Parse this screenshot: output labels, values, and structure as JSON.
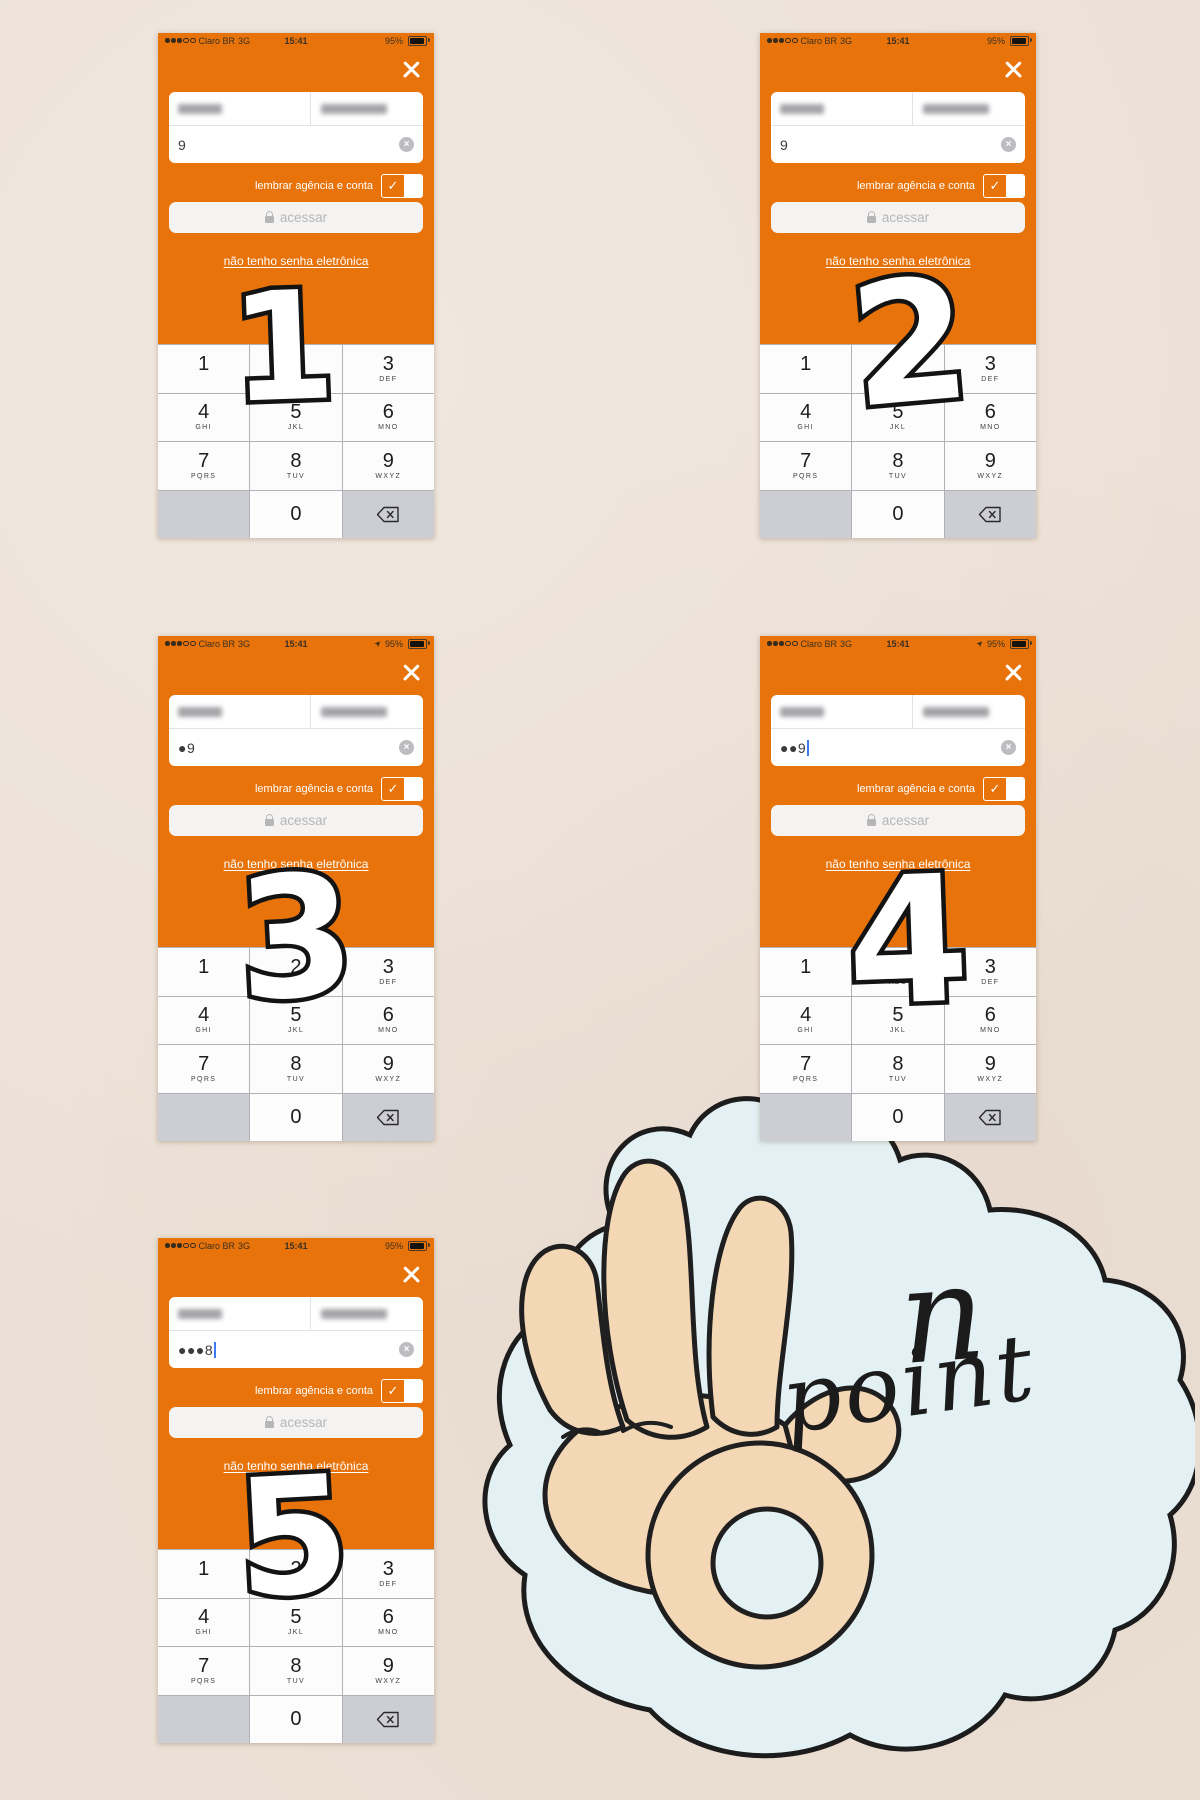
{
  "colors": {
    "orange": "#e8730a",
    "keypad_gray": "#cdced4",
    "sticker_blue": "#e3f1f5",
    "hand_skin": "#f4d8b6"
  },
  "status": {
    "carrier": "Claro BR",
    "network": "3G",
    "time": "15:41",
    "battery_percent": "95%"
  },
  "icons": {
    "clear_glyph": "×",
    "check_glyph": "✓",
    "location_glyph": "➤"
  },
  "labels": {
    "remember": "lembrar agência e conta",
    "access": "acessar",
    "no_password": "não tenho senha eletrônica"
  },
  "keypad": {
    "keys": [
      {
        "digit": "1",
        "letters": ""
      },
      {
        "digit": "2",
        "letters": "ABC"
      },
      {
        "digit": "3",
        "letters": "DEF"
      },
      {
        "digit": "4",
        "letters": "GHI"
      },
      {
        "digit": "5",
        "letters": "JKL"
      },
      {
        "digit": "6",
        "letters": "MNO"
      },
      {
        "digit": "7",
        "letters": "PQRS"
      },
      {
        "digit": "8",
        "letters": "TUV"
      },
      {
        "digit": "9",
        "letters": "WXYZ"
      }
    ],
    "zero": "0"
  },
  "phones": [
    {
      "overlay_number": "1",
      "password": "9",
      "show_cursor": false,
      "location_arrow": false
    },
    {
      "overlay_number": "2",
      "password": "9",
      "show_cursor": false,
      "location_arrow": false
    },
    {
      "overlay_number": "3",
      "password": "●9",
      "show_cursor": false,
      "location_arrow": true
    },
    {
      "overlay_number": "4",
      "password": "●●9",
      "show_cursor": true,
      "location_arrow": true
    },
    {
      "overlay_number": "5",
      "password": "●●●8",
      "show_cursor": true,
      "location_arrow": false
    }
  ],
  "sticker": {
    "word_top": "n",
    "word_bottom": "point"
  }
}
